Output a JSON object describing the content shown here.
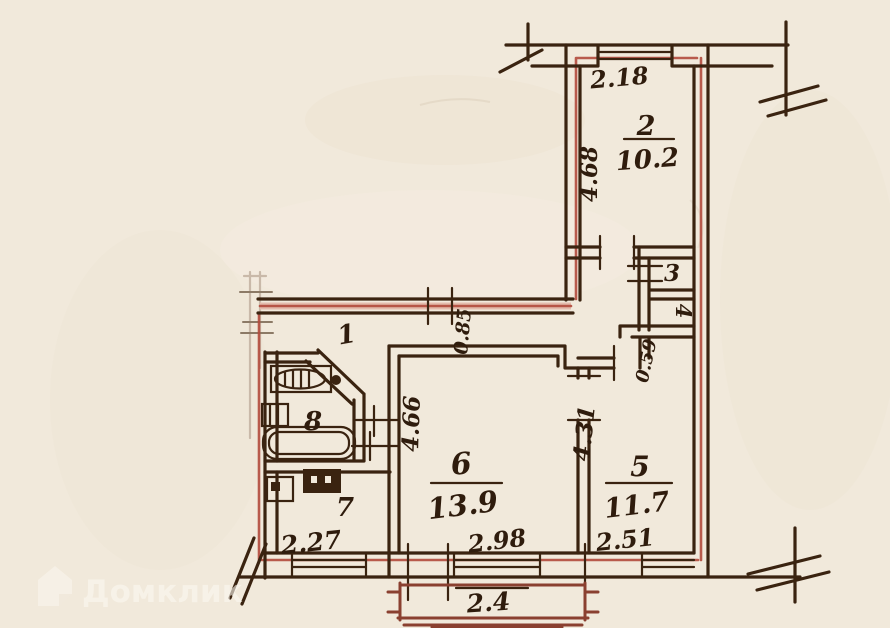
{
  "rooms": {
    "hall": {
      "number": "1"
    },
    "room2": {
      "number": "2",
      "area": "10.2"
    },
    "room3": {
      "number": "3"
    },
    "room4": {
      "number": "4"
    },
    "room5": {
      "number": "5",
      "area": "11.7"
    },
    "room6": {
      "number": "6",
      "area": "13.9"
    },
    "room7": {
      "number": "7"
    },
    "room8": {
      "number": "8"
    }
  },
  "dimensions": {
    "room2_width": "2.18",
    "room2_depth": "4.68",
    "hall_clear": "0.85",
    "pantry_door": "0.59",
    "room6_depth": "4.66",
    "room5_depth": "4.31",
    "kitchen_width": "2.27",
    "room6_width": "2.98",
    "room5_width": "2.51",
    "balcony_width": "2.4"
  },
  "watermark": {
    "label": "Домклик"
  },
  "colors": {
    "paper": "#f1e9db",
    "ink": "#3a2310",
    "accent_red": "#b14a3c",
    "accent_pink": "#e4bbac"
  }
}
